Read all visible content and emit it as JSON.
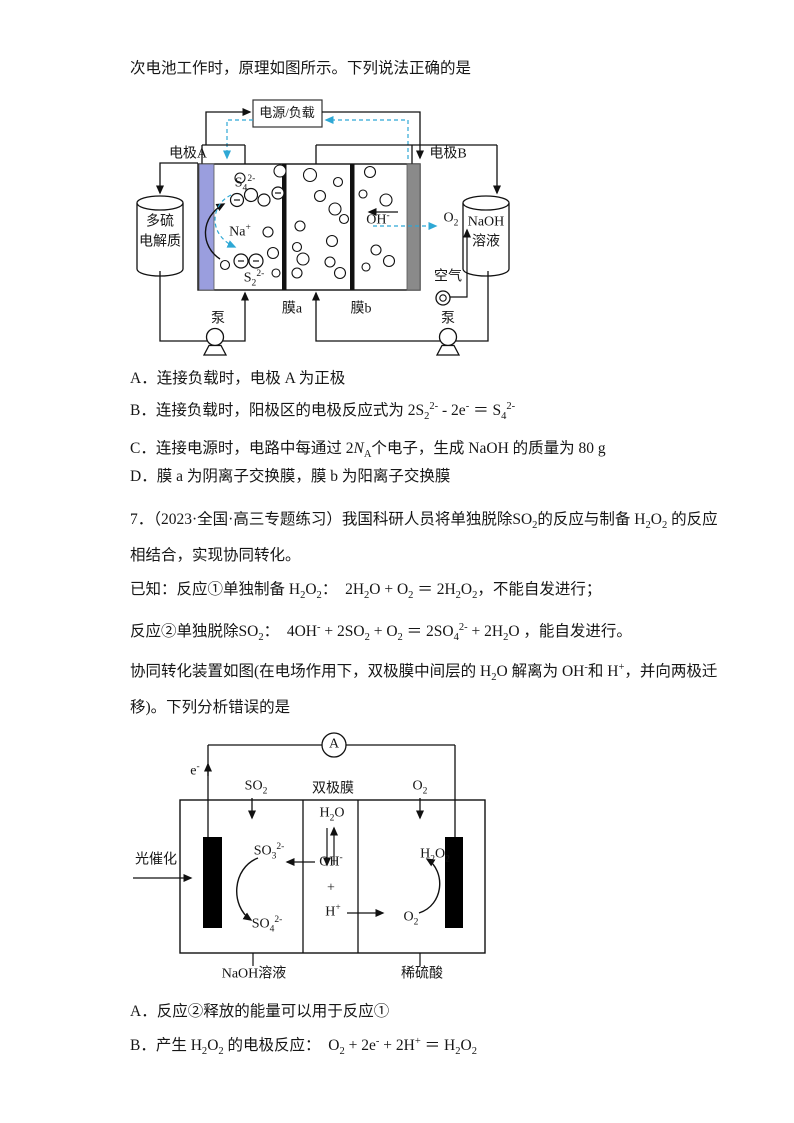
{
  "q6": {
    "intro": "次电池工作时，原理如图所示。下列说法正确的是",
    "options": [
      "A．连接负载时，电极 A 为正极",
      "B．连接负载时，阳极区的电极反应式为 2S<sub>2</sub><sup>2-</sup> - 2e<sup>-</sup> ＝ S<sub>4</sub><sup>2-</sup>",
      "C．连接电源时，电路中每通过 2<i>N</i><sub>A</sub>个电子，生成 NaOH 的质量为 80 g",
      "D．膜 a 为阴离子交换膜，膜 b 为阳离子交换膜"
    ]
  },
  "q7": {
    "lines": [
      "7．（2023·全国·高三专题练习）我国科研人员将单独脱除SO<sub>2</sub>的反应与制备 H<sub>2</sub>O<sub>2</sub> 的反应",
      "相结合，实现协同转化。",
      "已知：反应①单独制备 H<sub>2</sub>O<sub>2</sub>：  2H<sub>2</sub>O + O<sub>2</sub> ＝ 2H<sub>2</sub>O<sub>2</sub>，不能自发进行；",
      "反应②单独脱除SO<sub>2</sub>：  4OH<sup>-</sup> + 2SO<sub>2</sub> + O<sub>2</sub> ＝ 2SO<sub>4</sub><sup>2-</sup> + 2H<sub>2</sub>O ，能自发进行。",
      "协同转化装置如图(在电场作用下，双极膜中间层的 H<sub>2</sub>O 解离为 OH<sup>-</sup>和 H<sup>+</sup>，并向两极迁",
      "移)。下列分析错误的是"
    ],
    "options": [
      "A．反应②释放的能量可以用于反应①",
      "B．产生 H<sub>2</sub>O<sub>2</sub> 的电极反应：  O<sub>2</sub> + 2e<sup>-</sup> + 2H<sup>+</sup> ＝ H<sub>2</sub>O<sub>2</sub>"
    ]
  },
  "d1": {
    "power_box": "电源/负载",
    "electrode_a": "电极A",
    "electrode_b": "电极B",
    "cyl_left_line1": "多硫",
    "cyl_left_line2": "电解质",
    "cyl_right_line1": "NaOH",
    "cyl_right_line2": "溶液",
    "s4": "S<sub>4</sub><sup>2-</sup>",
    "na": "Na<sup>+</sup>",
    "s2": "S<sub>2</sub><sup>2-</sup>",
    "oh": "OH<sup>-</sup>",
    "o2": "O<sub>2</sub>",
    "air": "空气",
    "membrane_a": "膜a",
    "membrane_b": "膜b",
    "pump_left": "泵",
    "pump_right": "泵"
  },
  "d2": {
    "ammeter": "A",
    "electron": "e<sup>-</sup>",
    "so2_in": "SO<sub>2</sub>",
    "bipolar_membrane": "双极膜",
    "o2_in": "O<sub>2</sub>",
    "h2o": "H<sub>2</sub>O",
    "oh": "OH<sup>-</sup>",
    "plus": "+",
    "h_ion": "H<sup>+</sup>",
    "photocatalysis": "光催化",
    "so3": "SO<sub>3</sub><sup>2-</sup>",
    "so4": "SO<sub>4</sub><sup>2-</sup>",
    "h2o2": "H<sub>2</sub>O<sub>2</sub>",
    "o2_right": "O<sub>2</sub>",
    "naoh_solution": "NaOH溶液",
    "dilute_acid": "稀硫酸"
  },
  "colors": {
    "dashed_arrow": "#2ea8d5",
    "electrode_a_fill": "#9a9ede",
    "electrode_b_fill": "#8a8a8a",
    "membrane_fill": "#111111",
    "text": "#161616"
  }
}
